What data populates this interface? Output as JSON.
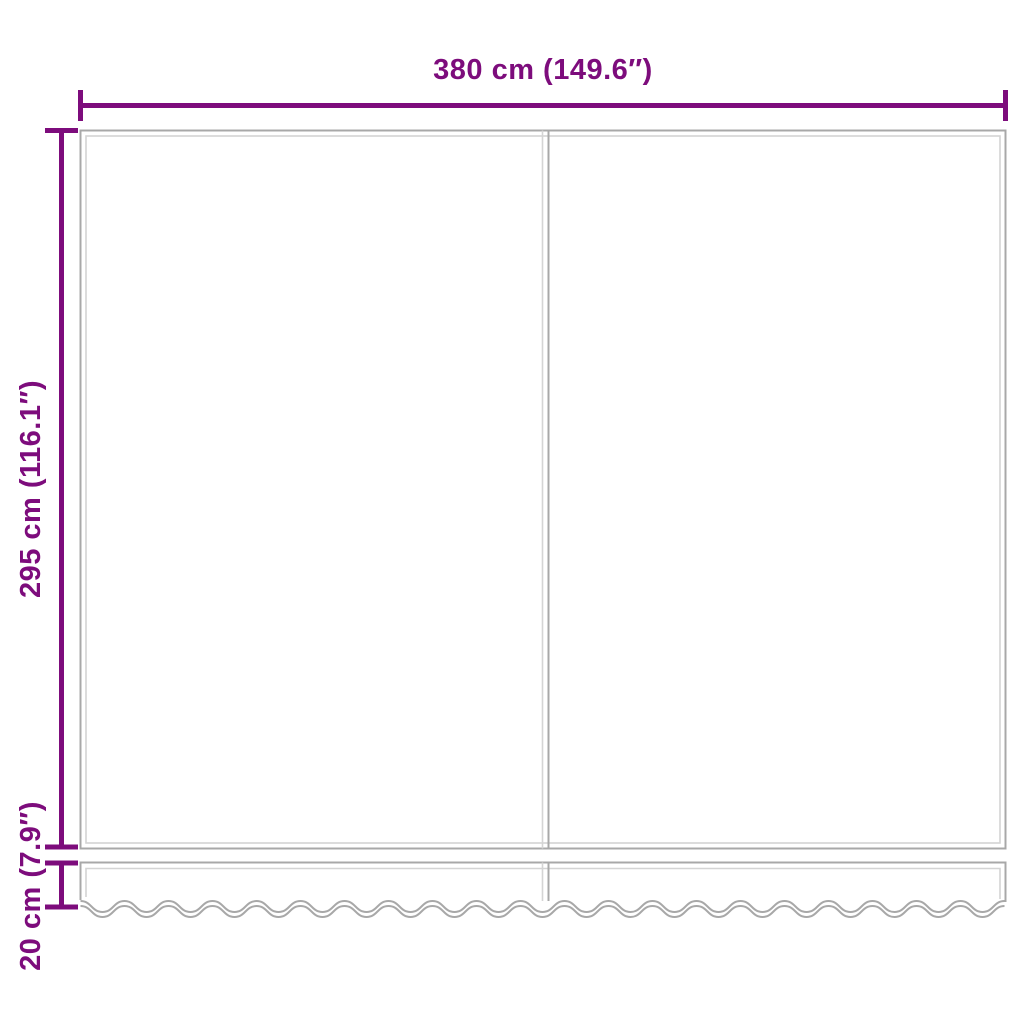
{
  "colors": {
    "accent": "#7D0C7C",
    "line_dark": "#A8A8A8",
    "line_light": "#D4D4D4",
    "background": "#FFFFFF"
  },
  "diagram": {
    "width_dimension": {
      "label": "380 cm (149.6″)"
    },
    "height_dimension": {
      "label": "295 cm (116.1″)"
    },
    "valance_dimension": {
      "label": "20 cm (7.9″)"
    }
  }
}
